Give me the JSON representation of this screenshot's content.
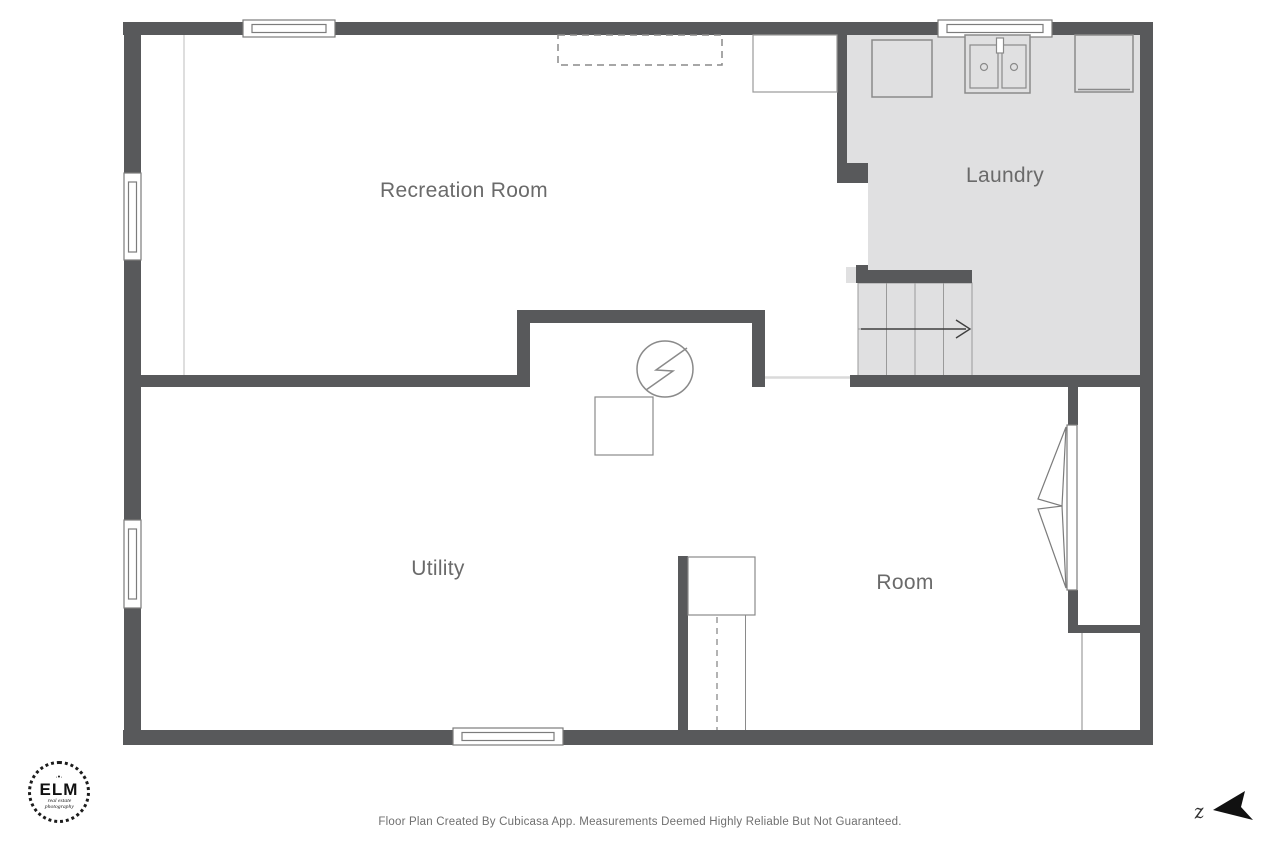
{
  "page": {
    "footer": "Floor Plan Created By Cubicasa App. Measurements Deemed Highly Reliable But Not Guaranteed."
  },
  "floorplan": {
    "rooms": [
      {
        "label": "Recreation Room"
      },
      {
        "label": "Laundry"
      },
      {
        "label": "Utility"
      },
      {
        "label": "Room"
      }
    ]
  },
  "logo": {
    "ornament": "·•·",
    "title": "ELM",
    "line1": "real estate",
    "line2": "photography"
  },
  "compass": {
    "letter": "z"
  },
  "colors": {
    "wall": "#58595B",
    "floor": "#E0E0E1",
    "fixture_line": "#8A8A8A",
    "label_text": "#6A6A6A"
  }
}
